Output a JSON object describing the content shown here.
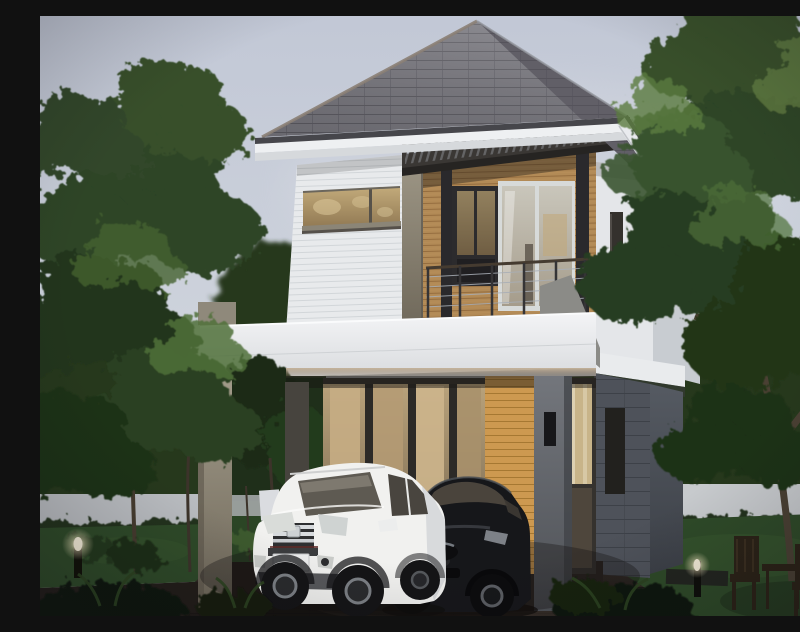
{
  "meta": {
    "title": "3D rendering of a two-story modern house at dusk",
    "description": "Architectural 3D rendering of a small two-story modern house with wood-slat accents, a slatted balcony pergola, and a carport sheltering a white SUV and a black Mazda sedan, framed by tall green trees, a lawn, glowing bollard lights and a wooden patio set at dusk."
  },
  "scene": {
    "sky": {
      "top": "#c2c8d6",
      "mid": "#ced3dc",
      "bottom": "#e3e4e6"
    },
    "colors": {
      "roof_front": "#76757c",
      "roof_side": "#615f67",
      "roof_rows": "#45444b",
      "ridge_cap": "#8b8076",
      "fascia": "#eef0f2",
      "gutter": "#46464b",
      "soffit": "#d6d9dc",
      "siding": "#e8eaec",
      "siding_line": "#d0d4d8",
      "wood": "#b28a56",
      "wood_line": "#8a6336",
      "wood_bright": "#cd9950",
      "wood_bright_line": "#9c6f2b",
      "pergola": "#3a3734",
      "frame_dark": "#2a292c",
      "glass_amber": "#c0a878",
      "glass_amber_deep": "#8d7550",
      "interior_glow": "#d6bd8f",
      "interior_deep": "#6e5f49",
      "slab": "#f1f2f4",
      "slab_shadow": "#8f9296",
      "concrete_light": "#9a9383",
      "concrete_dark": "#6b6e74",
      "wing_front": "#e4e6e9",
      "wing_side": "#c8ccd1",
      "wing_stone": "#4e525a",
      "sconce": "#17171a",
      "railing_cable": "#a8aeb6",
      "rail_wood": "#453b30",
      "fence_left": "#b9bcc0",
      "fence_right": "#c7cacd",
      "hedge": "#20331d",
      "lawn": "#2e4a28",
      "treeline": "#26381f",
      "tree_dark": "#22351d",
      "tree_mid": "#2d4426",
      "tree_mid2": "#37502c",
      "tree_light": "#50703a",
      "trunk": "#453b2e",
      "driveway": "#362e28",
      "driveway_dark": "#1f1a17",
      "car_white": "#f1f1ef",
      "car_white_shade": "#d8dadc",
      "car_black": "#16171a",
      "car_glass": "#4a443c",
      "plate": "#eceded",
      "glow": "#f6eeda",
      "shrub_dark": "#10170c",
      "furniture_wood": "#2b2217"
    },
    "objects": {
      "hip_roof": "Gray shingle hip roof",
      "upper_floor": "Second floor with white horizontal siding and amber clerestory windows",
      "wood_wall": "Wood slat feature wall",
      "pergola": "Dark slatted balcony pergola",
      "balcony_railing": "Steel cable balcony railing",
      "carport": "White carport slab on concrete pillars",
      "glass_doors": "Ground-floor glass sliding doors with warm interior light",
      "entry_door": "Side entry door with glass panel",
      "right_wing": "Set-back right wing with dark stone base",
      "white_suv": "White compact SUV (Honda CR-V style) with blank license plate",
      "black_sedan": "Black Mazda sedan with blank license plate",
      "left_trees": "Tall garden trees on the left",
      "right_tree": "Large leafy tree on the right",
      "fence": "Light boundary wall behind hedges",
      "lawn": "Garden lawn",
      "driveway": "Dark paver driveway",
      "bollard_lights": "Glowing garden bollard lights",
      "patio_set": "Wooden patio chairs and table",
      "wall_sconces": "Black wall sconce lamps",
      "shrubs": "Dark foreground shrubs"
    }
  }
}
